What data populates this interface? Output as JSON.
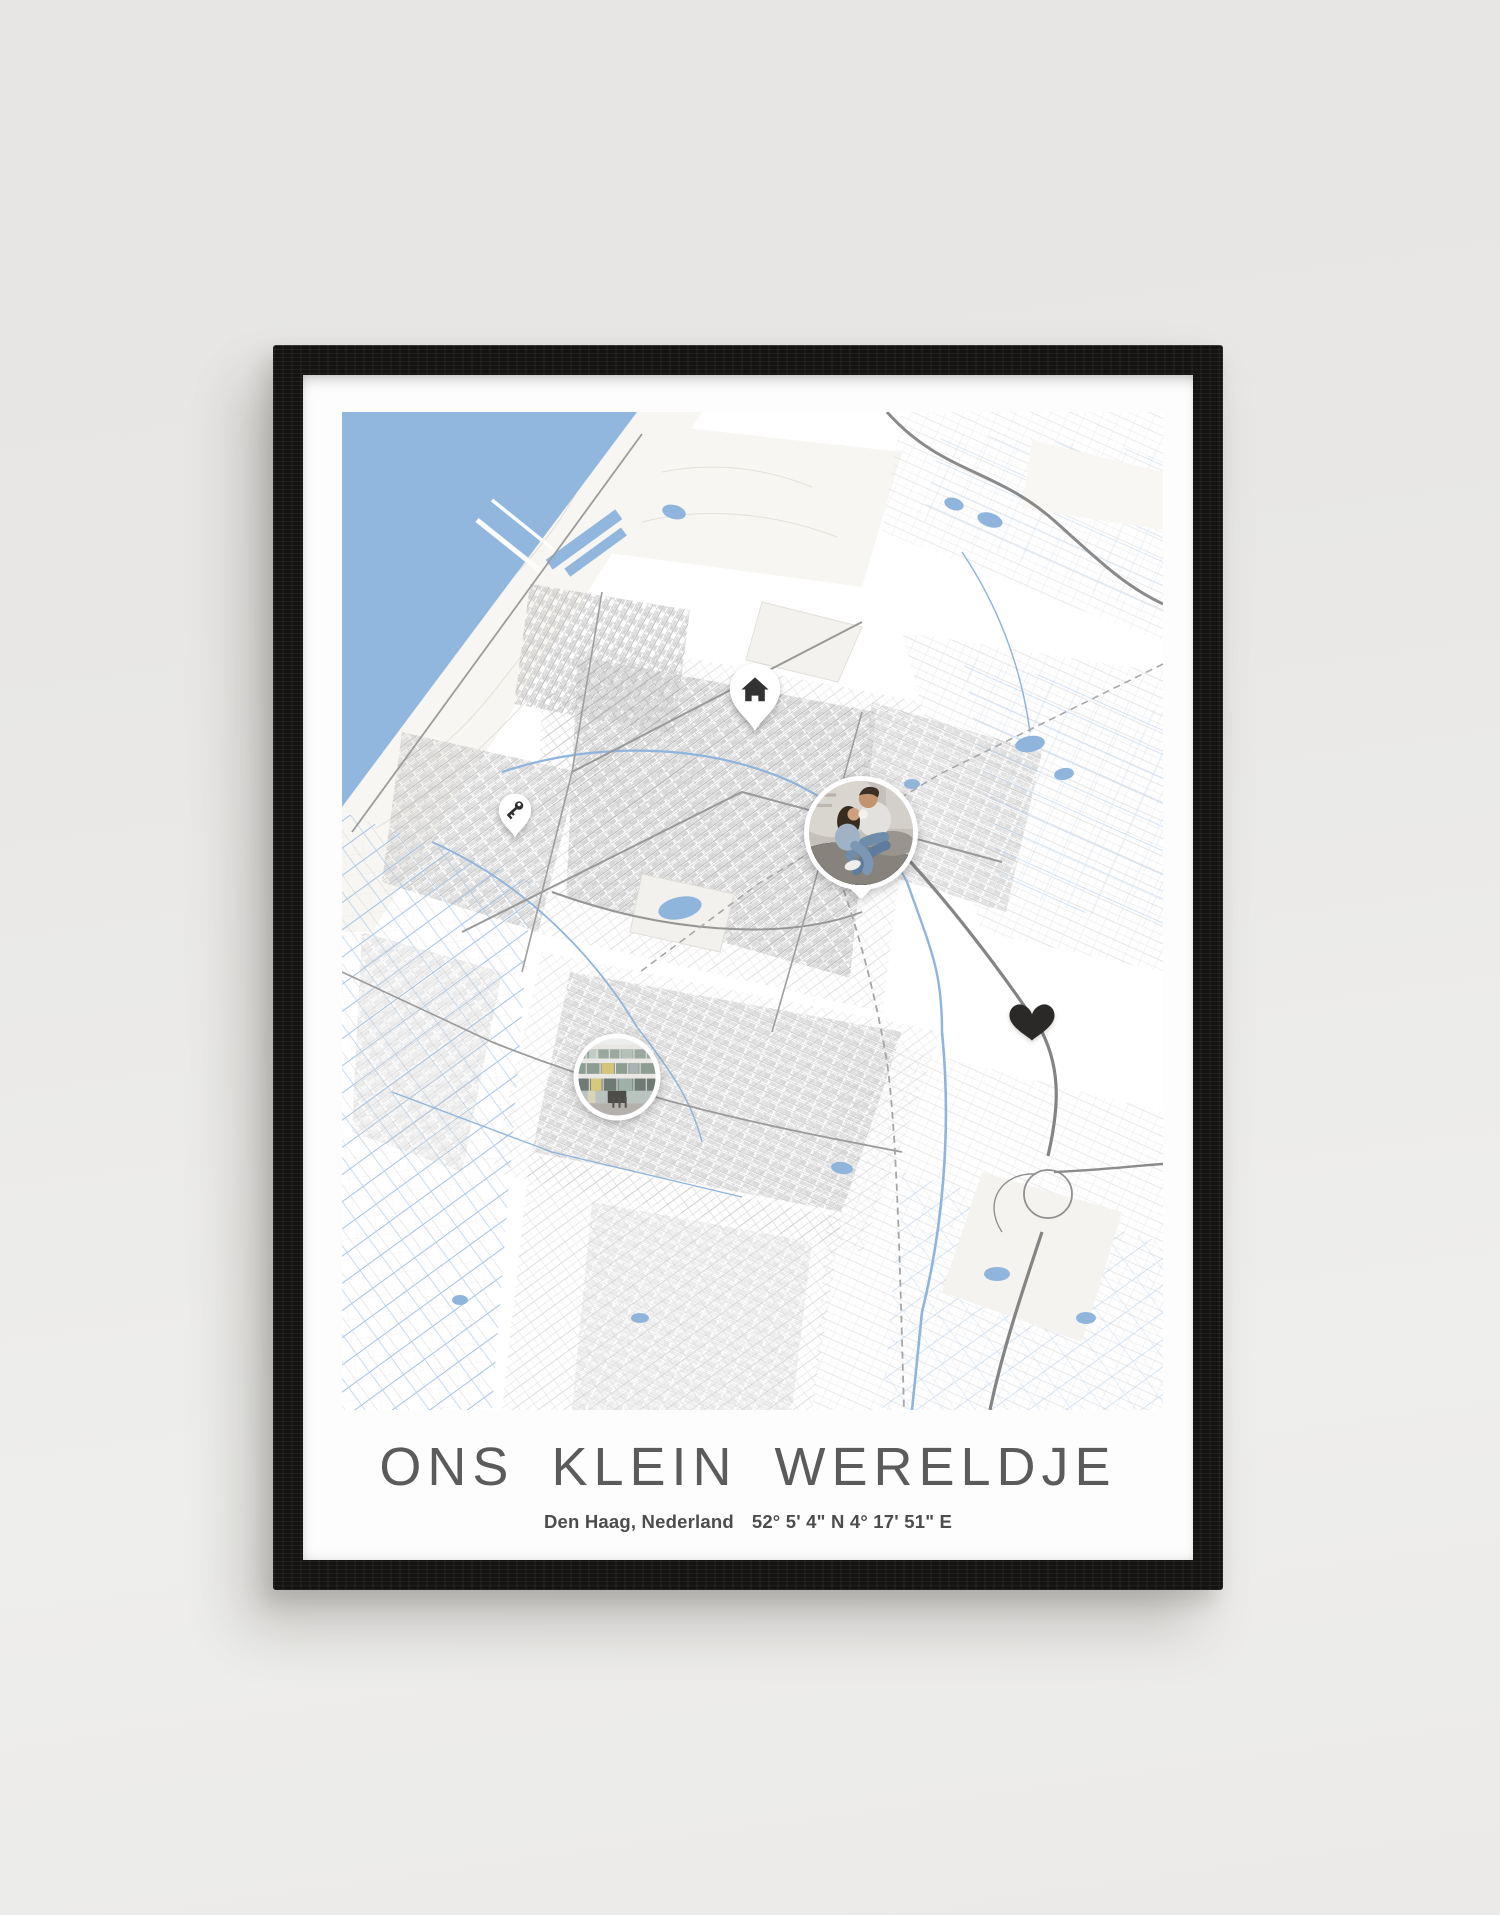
{
  "scene": {
    "description": "Product photo of a framed personalised city map poster standing against a light grey wall",
    "background_color": "#e9e8e6"
  },
  "frame": {
    "material": "black wood",
    "color": "#151311"
  },
  "poster": {
    "background_color": "#fdfdfd",
    "title": "ONS KLEIN WERELDJE",
    "title_color": "#5b5b5b",
    "location": "Den Haag, Nederland",
    "coordinates": "52° 5' 4\" N 4° 17' 51\" E"
  },
  "map": {
    "area": "Den Haag, Nederland",
    "style": "minimal monochrome street map with blue water",
    "land_color": "#ffffff",
    "sea_color": "#92b7de",
    "water_color": "#8fb5dd",
    "road_color": "#8c8c8c",
    "markers": [
      {
        "name": "home-pin",
        "kind": "pin",
        "icon": "house-icon",
        "x_pct": 50.3,
        "y_pct": 28.6,
        "width": 56,
        "height": 74
      },
      {
        "name": "key-pin",
        "kind": "pin",
        "icon": "key-icon",
        "x_pct": 21.1,
        "y_pct": 40.4,
        "width": 36,
        "height": 46
      },
      {
        "name": "photo-marker-couple",
        "kind": "photo",
        "subject": "couple laughing together on a couch",
        "x_pct": 63.2,
        "y_pct": 42.2,
        "width": 114,
        "height": 114
      },
      {
        "name": "heart-marker",
        "kind": "heart",
        "x_pct": 84.0,
        "y_pct": 61.1,
        "width": 47,
        "height": 42
      },
      {
        "name": "photo-marker-building",
        "kind": "photo",
        "subject": "modern glass office building",
        "x_pct": 33.5,
        "y_pct": 66.6,
        "width": 87,
        "height": 87
      }
    ]
  }
}
